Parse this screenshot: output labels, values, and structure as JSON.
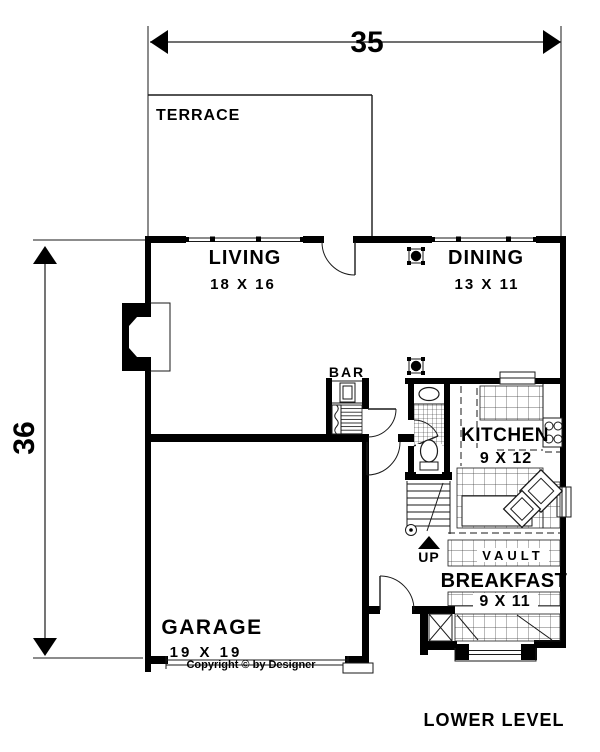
{
  "plan": {
    "title": "LOWER LEVEL",
    "copyright": "Copyright © by Designer",
    "overall_width_ft": "35",
    "overall_height_ft": "36"
  },
  "rooms": {
    "terrace": {
      "name": "TERRACE"
    },
    "living": {
      "name": "LIVING",
      "size": "18 X 16"
    },
    "dining": {
      "name": "DINING",
      "size": "13 X 11"
    },
    "bar": {
      "name": "BAR"
    },
    "kitchen": {
      "name": "KITCHEN",
      "size": "9 X 12"
    },
    "breakfast": {
      "name": "BREAKFAST",
      "size": "9 X 11"
    },
    "garage": {
      "name": "GARAGE",
      "size": "19 X 19"
    }
  },
  "annotations": {
    "vault": "VAULT",
    "stairs_up": "UP"
  },
  "colors": {
    "ink": "#000000",
    "paper": "#ffffff"
  }
}
